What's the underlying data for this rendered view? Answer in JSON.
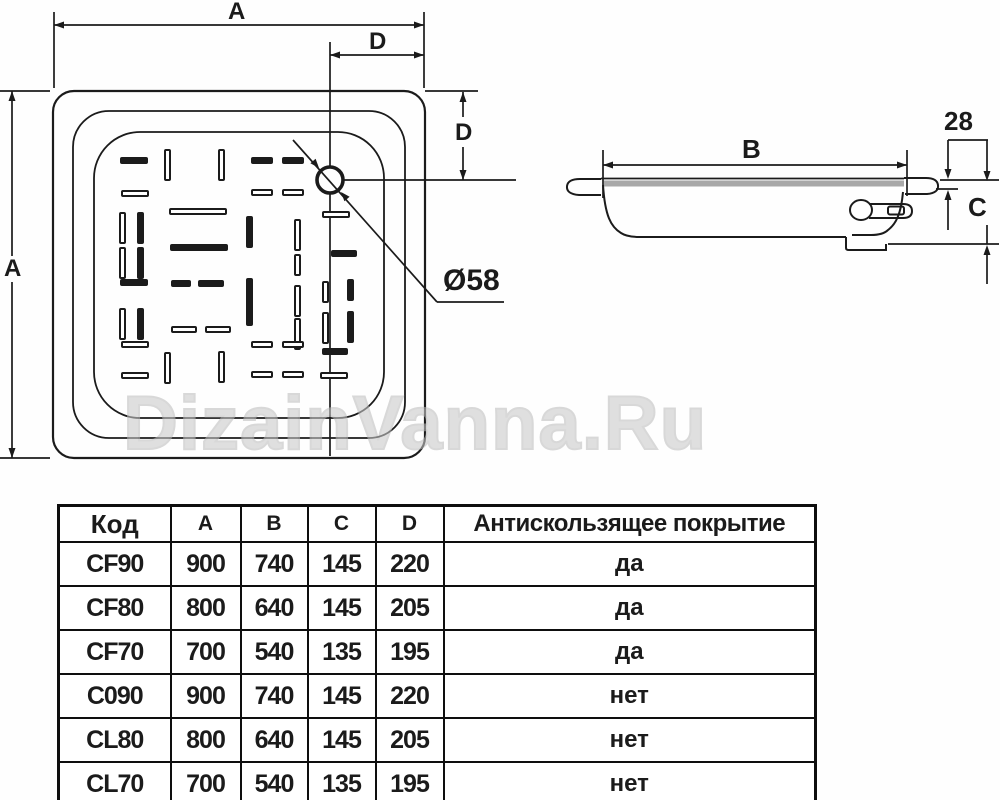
{
  "diagram": {
    "labels": {
      "dim_a_top": "A",
      "dim_d_top": "D",
      "dim_a_left": "A",
      "dim_d_right": "D",
      "drain_diameter": "Ø58",
      "dim_b": "B",
      "dim_rim": "28",
      "dim_c": "C"
    },
    "line_color": "#1b1b1b",
    "rim_band_color": "#a8a8a8",
    "pattern": [
      [
        120,
        157,
        "h",
        1
      ],
      [
        164,
        149,
        "v",
        0
      ],
      [
        218,
        149,
        "v",
        0
      ],
      [
        251,
        157,
        "h",
        1,
        22
      ],
      [
        282,
        157,
        "h",
        1,
        22
      ],
      [
        121,
        190,
        "h",
        0
      ],
      [
        251,
        189,
        "h",
        0,
        22
      ],
      [
        282,
        189,
        "h",
        0,
        22
      ],
      [
        119,
        212,
        "v",
        0
      ],
      [
        137,
        212,
        "v",
        1
      ],
      [
        169,
        208,
        "h",
        0,
        58
      ],
      [
        246,
        216,
        "v",
        1
      ],
      [
        294,
        219,
        "v",
        0
      ],
      [
        322,
        211,
        "h",
        0,
        28
      ],
      [
        119,
        247,
        "v",
        0
      ],
      [
        137,
        247,
        "v",
        1
      ],
      [
        170,
        244,
        "h",
        1,
        58
      ],
      [
        294,
        254,
        "v",
        0,
        22
      ],
      [
        331,
        250,
        "h",
        1,
        26
      ],
      [
        120,
        279,
        "h",
        1
      ],
      [
        171,
        280,
        "h",
        1,
        20
      ],
      [
        198,
        280,
        "h",
        1,
        26
      ],
      [
        246,
        278,
        "v",
        1,
        48
      ],
      [
        294,
        285,
        "v",
        0
      ],
      [
        322,
        281,
        "v",
        0,
        22
      ],
      [
        347,
        279,
        "v",
        1,
        22
      ],
      [
        119,
        308,
        "v",
        0
      ],
      [
        137,
        308,
        "v",
        1
      ],
      [
        171,
        326,
        "h",
        0,
        26
      ],
      [
        205,
        326,
        "h",
        0,
        26
      ],
      [
        294,
        318,
        "v",
        0
      ],
      [
        322,
        312,
        "v",
        0
      ],
      [
        347,
        311,
        "v",
        1
      ],
      [
        121,
        341,
        "h",
        0
      ],
      [
        164,
        352,
        "v",
        0
      ],
      [
        218,
        351,
        "v",
        0
      ],
      [
        251,
        341,
        "h",
        0,
        22
      ],
      [
        282,
        341,
        "h",
        0,
        22
      ],
      [
        322,
        348,
        "h",
        1,
        26
      ],
      [
        121,
        372,
        "h",
        0
      ],
      [
        251,
        371,
        "h",
        0,
        22
      ],
      [
        282,
        371,
        "h",
        0,
        22
      ],
      [
        320,
        372,
        "h",
        0,
        28
      ]
    ]
  },
  "watermark": {
    "text": "DizainVanna.Ru"
  },
  "table": {
    "headers": [
      "Код",
      "A",
      "B",
      "C",
      "D",
      "Антискользящее покрытие"
    ],
    "rows": [
      [
        "CF90",
        "900",
        "740",
        "145",
        "220",
        "да"
      ],
      [
        "CF80",
        "800",
        "640",
        "145",
        "205",
        "да"
      ],
      [
        "CF70",
        "700",
        "540",
        "135",
        "195",
        "да"
      ],
      [
        "C090",
        "900",
        "740",
        "145",
        "220",
        "нет"
      ],
      [
        "CL80",
        "800",
        "640",
        "145",
        "205",
        "нет"
      ],
      [
        "CL70",
        "700",
        "540",
        "135",
        "195",
        "нет"
      ]
    ]
  }
}
